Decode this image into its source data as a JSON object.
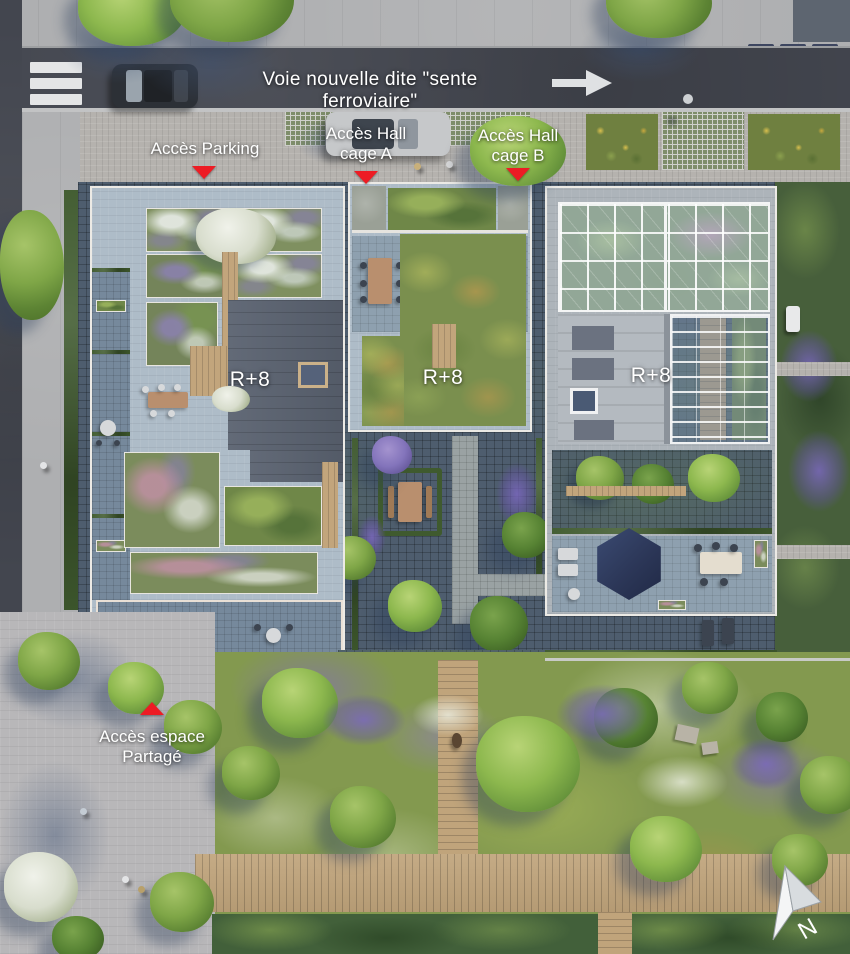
{
  "road": {
    "name_label": "Voie nouvelle dite \"sente ferroviaire\""
  },
  "annotations": {
    "parking": {
      "text": "Accès Parking"
    },
    "hall_a": {
      "line1": "Accès Hall",
      "line2": "cage A"
    },
    "hall_b": {
      "line1": "Accès Hall",
      "line2": "cage B"
    },
    "shared_space": {
      "line1": "Accès espace",
      "line2": "Partagé"
    }
  },
  "buildings": {
    "left_label": "R+8",
    "middle_label": "R+8",
    "right_label": "R+8"
  },
  "compass": {
    "north_label": "N"
  },
  "colors": {
    "marker_red": "#ed1c24",
    "label_text": "#ffffff",
    "road_asphalt": "#43464f",
    "canopy_navy": "#2c3758",
    "glass_blue": "#bbccdb"
  }
}
